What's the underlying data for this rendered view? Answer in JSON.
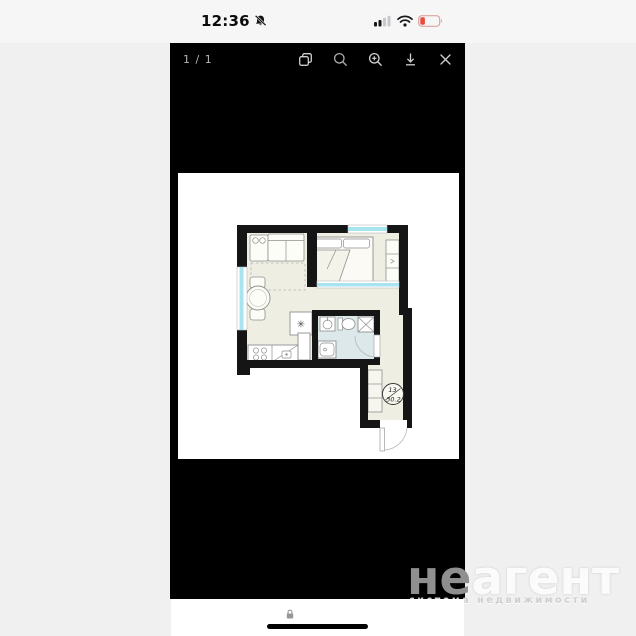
{
  "status_bar": {
    "time": "12:36",
    "notifications_muted_icon": "bell-slash",
    "cell_signal_bars_filled": 2,
    "wifi_icon": "wifi-full",
    "battery_state": "low",
    "battery_color": "#eb4d3d"
  },
  "viewer": {
    "page_indicator": "1 / 1",
    "toolbar_icons": [
      "pages",
      "zoom-out",
      "zoom-in",
      "download",
      "close"
    ]
  },
  "floor_plan": {
    "unit_number": "13",
    "unit_area": "30.2",
    "fridge_symbol": "✳",
    "colors": {
      "wall": "#151515",
      "room_fill": "#efeee3",
      "bathroom_fill": "#dce8ea",
      "window_glass": "#a8e4ef",
      "furniture_line": "#8f8f8f"
    }
  },
  "watermark": {
    "brand_prefix": "не",
    "brand_suffix": "агент",
    "tagline": "система недвижимости"
  },
  "bottom_bar": {
    "lock_icon": "padlock"
  }
}
